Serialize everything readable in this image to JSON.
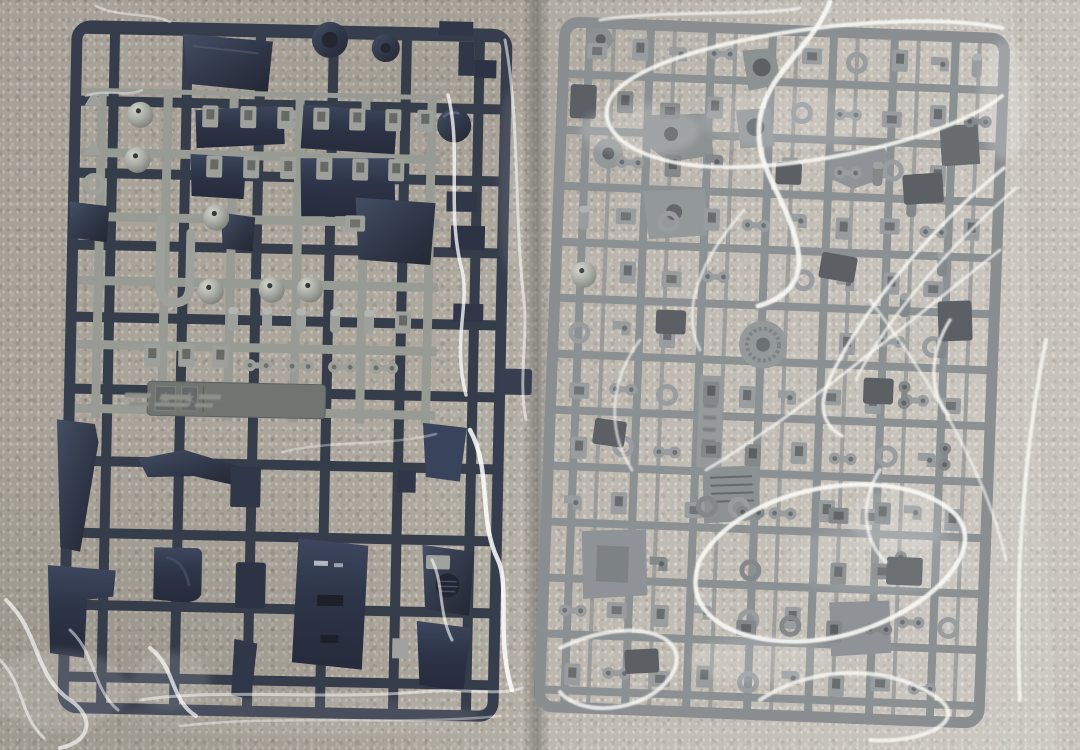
{
  "scene": {
    "description": "Photograph of two plastic model kit part sprues (runners), each sealed in a clear plastic bag, lying side by side on a mottled gray carpet",
    "surface": "gray carpet"
  },
  "left_bag": {
    "label": "left plastic bag with dark navy sprue",
    "bag_finish": "clear polyethylene, light crinkle highlights",
    "sprue_colors": {
      "frame": "#2a3140",
      "parts_dark": "#222a3c",
      "sub_runner_gray": "#989b93",
      "ball_joint_gray": "#a9aca3"
    },
    "molded_label": {
      "legible": false,
      "style": "embossed rosette icons and italic embossed text"
    }
  },
  "right_bag": {
    "label": "right plastic bag with light gray sprue",
    "bag_finish": "glossy clear plastic with bright white specular reflections",
    "sprue_colors": {
      "frame": "#7c8183",
      "parts_light": "#8d9193",
      "parts_mid": "#75797c",
      "parts_dark": "#4e5356"
    }
  },
  "palette": {
    "carpet_left": "#aba49a",
    "carpet_right": "#c9c7c1",
    "reflection_white": "#fafaf6",
    "seam_shadow": "#2d2d30"
  }
}
